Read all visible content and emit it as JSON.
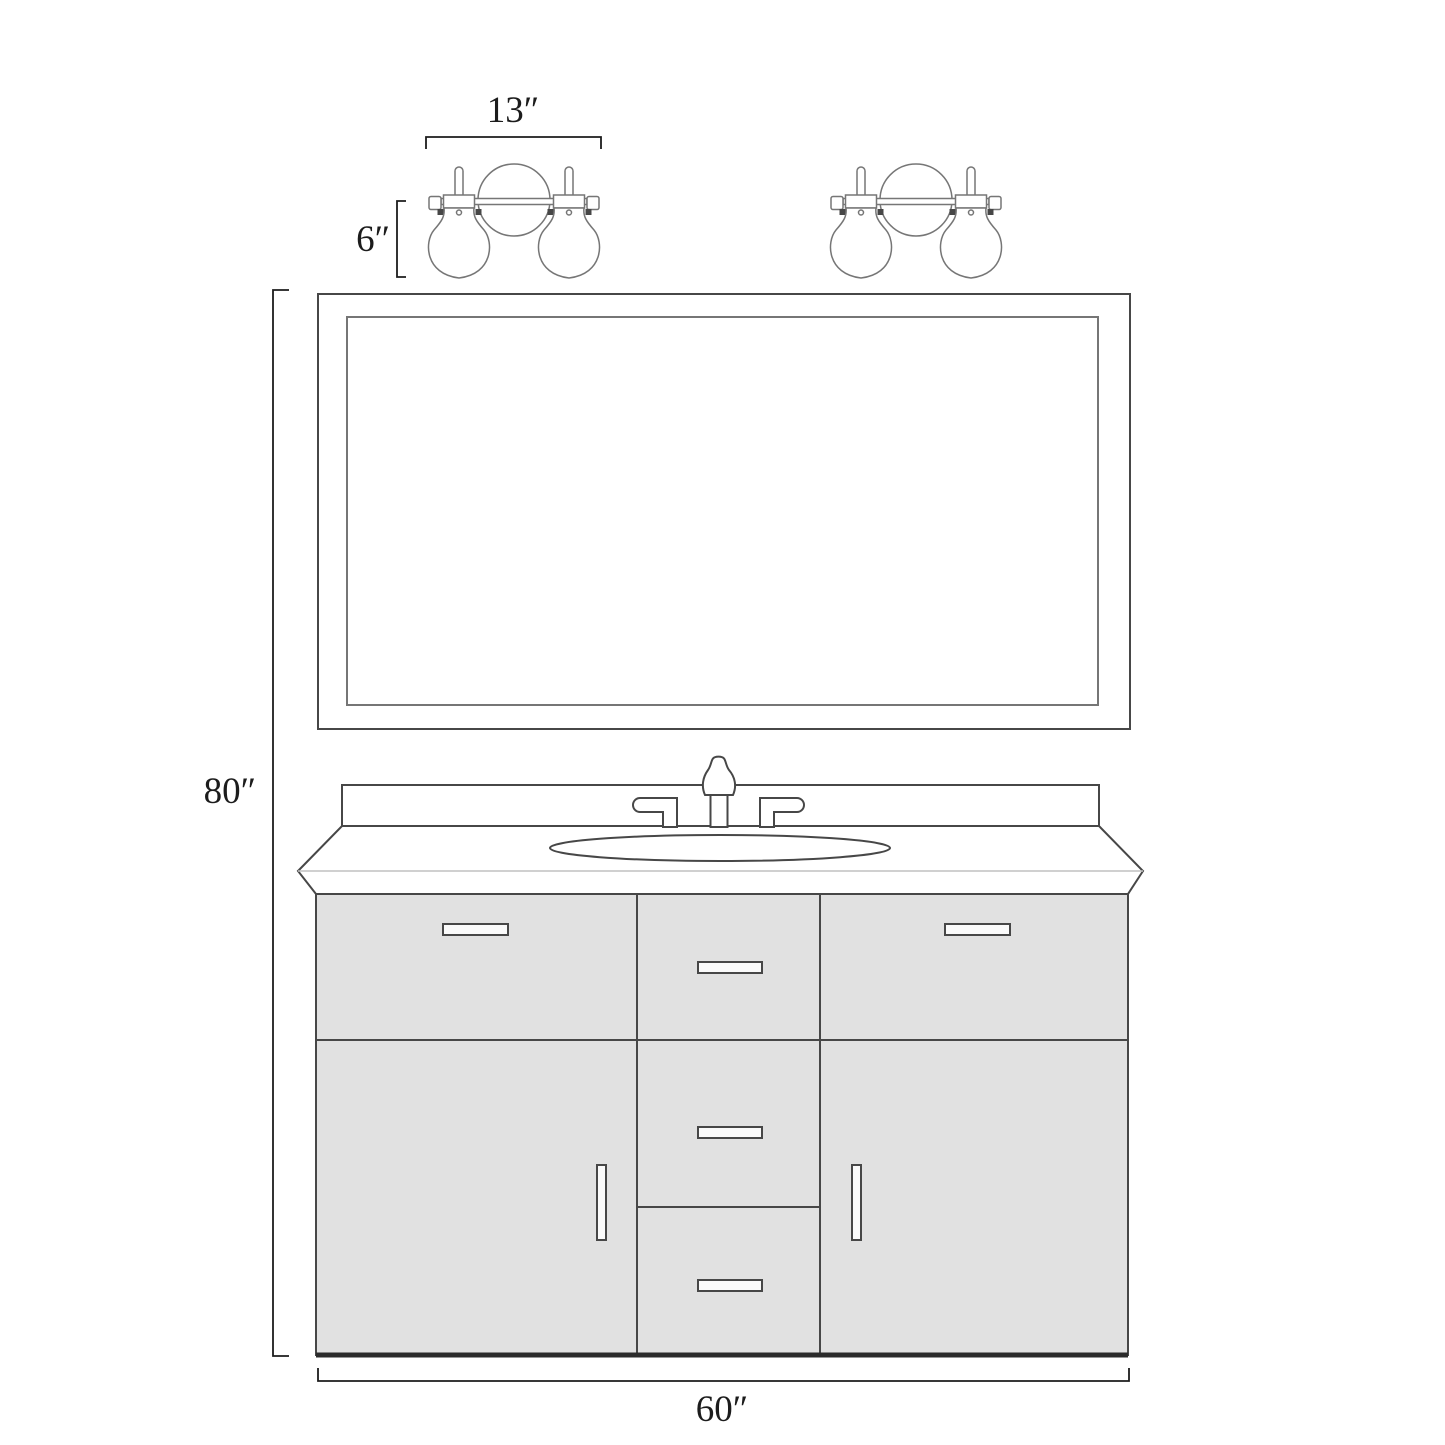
{
  "diagram": {
    "name": "bathroom-vanity-dimension-drawing",
    "dimensions": {
      "light_fixture_width": "13″",
      "light_fixture_height": "6″",
      "overall_height": "80″",
      "vanity_width": "60″"
    },
    "parts": {
      "left_fixture": "two-bulb-vanity-sconce",
      "right_fixture": "two-bulb-vanity-sconce",
      "mirror": "framed-rectangular-mirror",
      "countertop": "beveled-countertop-with-backsplash",
      "sink": "oval-undermount-sink",
      "faucet": "widespread-faucet-two-handles",
      "cabinet": "vanity-cabinet-3-drawers-top-2-doors-2-center-drawers"
    },
    "colors": {
      "background": "#ffffff",
      "line": "#474747",
      "line_light": "#767676",
      "crease": "#c0c0c0",
      "cabinet_fill": "#e1e1e1",
      "handle_fill": "#fafafa",
      "base": "#2b2b2b",
      "text": "#1c1c1c"
    }
  }
}
